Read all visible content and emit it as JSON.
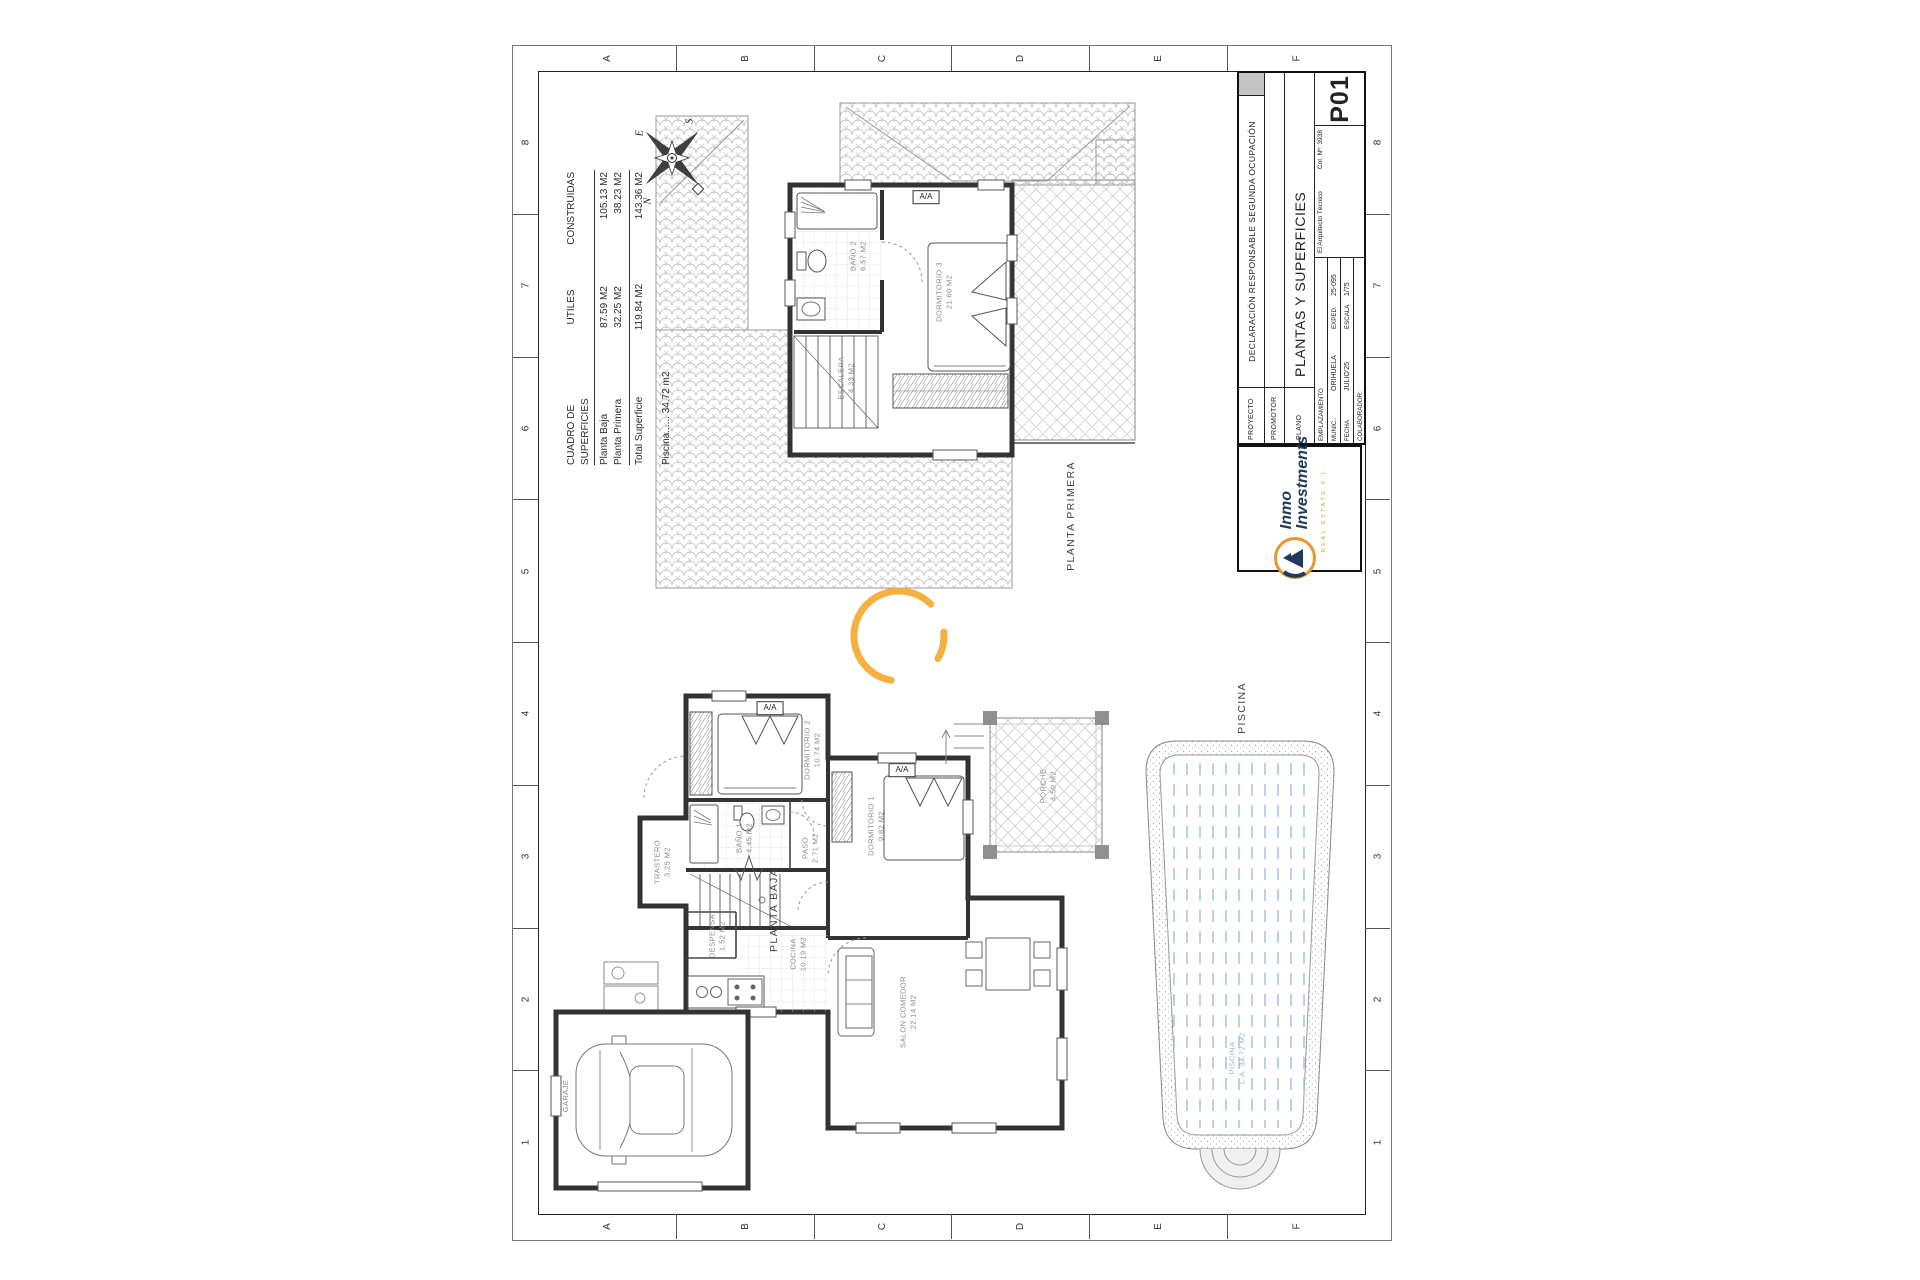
{
  "sheet": {
    "grid_letters": [
      "A",
      "B",
      "C",
      "D",
      "E",
      "F"
    ],
    "grid_numbers": [
      "8",
      "7",
      "6",
      "5",
      "4",
      "3",
      "2",
      "1"
    ]
  },
  "surfaces_table": {
    "title": "CUADRO DE SUPERFICIES",
    "col_utiles": "UTILES",
    "col_construidas": "CONSTRUIDAS",
    "rows": [
      {
        "label": "Planta Baja",
        "utiles": "87.59 M2",
        "construidas": "105.13 M2"
      },
      {
        "label": "Planta Primera",
        "utiles": "32.25 M2",
        "construidas": "38.23 M2"
      }
    ],
    "total_label": "Total Superficie",
    "total_utiles": "119.84 M2",
    "total_construidas": "143.36 M2",
    "piscina_line": "Piscina......  34.72 m2"
  },
  "title_block": {
    "proyecto_label": "PROYECTO",
    "proyecto_value": "DECLARACIÓN RESPONSABLE SEGUNDA OCUPACIÓN",
    "promotor_label": "PROMOTOR",
    "plano_label": "PLANO",
    "plano_value": "PLANTAS Y SUPERFICIES",
    "arquitecto": "El Arquitecto Técnico",
    "colegiado": "Col. Nº: 3938",
    "emplazamiento_label": "EMPLAZAMIENTO",
    "munic_label": "MUNIC.:",
    "munic_value": "ORIHUELA",
    "exped_label": "EXPED.",
    "exped_value": "25-095",
    "fecha_label": "FECHA",
    "fecha_value": "JULIO'25",
    "escala_label": "ESCALA",
    "escala_value": "1/75",
    "colaborador_label": "COLABORADOR:",
    "sheet_number": "P01"
  },
  "logo": {
    "line1": "Inmo",
    "line2": "Investments",
    "tagline": "REAL ESTATE S.L."
  },
  "colors": {
    "accent_arc": "#F5B041",
    "logo_navy": "#1E3B5E",
    "logo_orange": "#E8962E",
    "pool_blue": "#A9C6E2",
    "gray_cell": "#C4C4C4"
  },
  "aa_label": "A/A",
  "aa_units": [
    {
      "x": 926,
      "y": 197
    },
    {
      "x": 770,
      "y": 708
    },
    {
      "x": 902,
      "y": 770
    }
  ],
  "plan_labels": [
    {
      "x": 1072,
      "y": 516,
      "size": 10.5,
      "color": "#444",
      "ls": 1.4,
      "lines": [
        "PLANTA PRIMERA"
      ]
    },
    {
      "x": 775,
      "y": 910,
      "size": 10.5,
      "color": "#444",
      "ls": 1.4,
      "lines": [
        "PLANTA BAJA"
      ]
    },
    {
      "x": 1243,
      "y": 708,
      "size": 10.5,
      "color": "#444",
      "ls": 1.4,
      "lines": [
        "PISCINA"
      ]
    },
    {
      "x": 858,
      "y": 256,
      "lines": [
        "BAÑO 2",
        "6.57 M2"
      ]
    },
    {
      "x": 944,
      "y": 292,
      "lines": [
        "DORMITORIO 3",
        "21.60 M2"
      ]
    },
    {
      "x": 846,
      "y": 378,
      "lines": [
        "ESCALERA",
        "4.33 M2"
      ]
    },
    {
      "x": 812,
      "y": 750,
      "lines": [
        "DORMITORIO 2",
        "10.74 M2"
      ]
    },
    {
      "x": 876,
      "y": 826,
      "lines": [
        "DORMITORIO 1",
        "9.82 M2"
      ]
    },
    {
      "x": 744,
      "y": 838,
      "lines": [
        "BAÑO 1",
        "4.45 M2"
      ]
    },
    {
      "x": 810,
      "y": 848,
      "lines": [
        "PASO",
        "2.71 M2"
      ]
    },
    {
      "x": 662,
      "y": 862,
      "lines": [
        "TRASTERO",
        "3.25 M2"
      ]
    },
    {
      "x": 717,
      "y": 936,
      "lines": [
        "DESPENSA",
        "1.52 M2"
      ]
    },
    {
      "x": 798,
      "y": 954,
      "lines": [
        "COCINA",
        "10.19 M2"
      ]
    },
    {
      "x": 908,
      "y": 1012,
      "lines": [
        "SALON COMEDOR",
        "22.14 M2"
      ]
    },
    {
      "x": 1048,
      "y": 786,
      "lines": [
        "PORCHE",
        "4.50 M2"
      ]
    },
    {
      "x": 566,
      "y": 1096,
      "lines": [
        "GARAJE"
      ]
    },
    {
      "x": 1237,
      "y": 1058,
      "color": "#9eb4c9",
      "lines": [
        "PISCINA",
        "L.A. 34.72 M2"
      ]
    },
    {
      "x": 640,
      "y": 133,
      "size": 10,
      "color": "#222",
      "serif": true,
      "lines": [
        "E"
      ]
    },
    {
      "x": 690,
      "y": 121,
      "size": 10,
      "color": "#222",
      "serif": true,
      "lines": [
        "S"
      ]
    },
    {
      "x": 648,
      "y": 201,
      "size": 10,
      "color": "#222",
      "serif": true,
      "lines": [
        "N"
      ]
    }
  ]
}
